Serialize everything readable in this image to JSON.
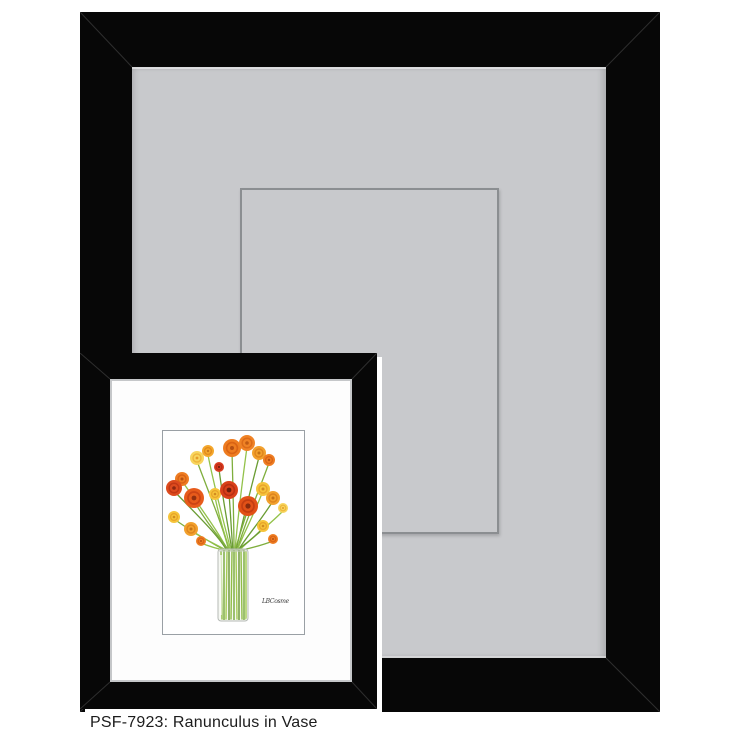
{
  "caption": {
    "text": "PSF-7923: Ranunculus in Vase"
  },
  "artwork": {
    "sku": "PSF-7923",
    "title": "Ranunculus in Vase",
    "signature": "LBCosme"
  },
  "colors": {
    "page_background": "#ffffff",
    "frame_black": "#070707",
    "mat_gray": "#c8c9cc",
    "mat_opening_line": "#8b8e91",
    "small_frame_separator": "#ffffff",
    "inner_mat_white": "#fdfdfd",
    "inner_mat_bevel": "#c5c7c9",
    "art_border": "#9aa0a5",
    "stem_greens": [
      "#7fae3d",
      "#93c24a",
      "#6a9c33"
    ],
    "flower_palette": [
      "#da3c20",
      "#e75b1b",
      "#ee7d22",
      "#f2a12e",
      "#f6c43b",
      "#f7d55f"
    ],
    "caption_text": "#1c1c1c"
  }
}
